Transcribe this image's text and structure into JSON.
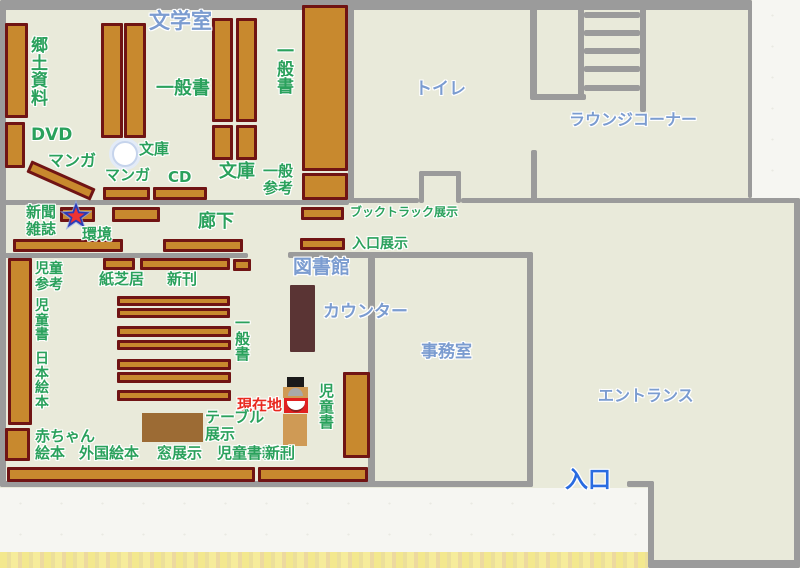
{
  "title": "図書館フロアマップ",
  "colors": {
    "background": "#e9eada",
    "wall": "#9b9b9b",
    "shelf_fill": "#c8892e",
    "shelf_border": "#701414",
    "green": "#2aa15c",
    "blue": "#7b9cd0",
    "blue_strong": "#2a6ce0",
    "red": "#e8281e",
    "counter": "#5a3434",
    "table": "#9c6b34",
    "kiosk_tan": "#cf9a55",
    "kiosk_red": "#e02020",
    "kiosk_black": "#1a1a1a",
    "star_red": "#ee3333",
    "star_blue": "#2b3ab5",
    "star_glow": "#8ea6e8",
    "paper": "#f6f6f2"
  },
  "canvas": {
    "width": 800,
    "height": 568
  },
  "paper_regions": [
    {
      "id": "paper-top-right",
      "x": 752,
      "y": 0,
      "w": 48,
      "h": 198
    },
    {
      "id": "paper-bottom-left",
      "x": 0,
      "y": 488,
      "w": 648,
      "h": 80
    }
  ],
  "yellow_band": {
    "id": "paper-edge-yellow",
    "x": 0,
    "y": 552,
    "w": 648,
    "h": 16
  },
  "walls": [
    {
      "id": "wall-top",
      "x": 0,
      "y": 0,
      "w": 752,
      "h": 10
    },
    {
      "id": "wall-left",
      "x": 0,
      "y": 0,
      "w": 6,
      "h": 487
    },
    {
      "id": "wall-bottom-left",
      "x": 0,
      "y": 481,
      "w": 533,
      "h": 6
    },
    {
      "id": "wall-corridor-top",
      "x": 0,
      "y": 200,
      "w": 349,
      "h": 5
    },
    {
      "id": "wall-corridor-bottom-left",
      "x": 0,
      "y": 253,
      "w": 248,
      "h": 5
    },
    {
      "id": "wall-corridor-bottom-right",
      "x": 288,
      "y": 252,
      "w": 245,
      "h": 6
    },
    {
      "id": "wall-toilet-left",
      "x": 348,
      "y": 5,
      "w": 6,
      "h": 198
    },
    {
      "id": "wall-toilet-bottom-a",
      "x": 348,
      "y": 198,
      "w": 71,
      "h": 5
    },
    {
      "id": "wall-toilet-door-notch-left",
      "x": 419,
      "y": 171,
      "w": 5,
      "h": 32
    },
    {
      "id": "wall-toilet-door-notch-top",
      "x": 419,
      "y": 171,
      "w": 42,
      "h": 5
    },
    {
      "id": "wall-toilet-door-notch-right",
      "x": 456,
      "y": 171,
      "w": 5,
      "h": 32
    },
    {
      "id": "wall-toilet-bottom-b",
      "x": 461,
      "y": 198,
      "w": 339,
      "h": 5
    },
    {
      "id": "wall-toilet-lounge-divider-top",
      "x": 530,
      "y": 0,
      "w": 7,
      "h": 98
    },
    {
      "id": "wall-lounge-balustrade",
      "x": 530,
      "y": 94,
      "w": 56,
      "h": 6
    },
    {
      "id": "wall-toilet-lounge-divider-bottom",
      "x": 531,
      "y": 150,
      "w": 6,
      "h": 53
    },
    {
      "id": "wall-map-right-top",
      "x": 748,
      "y": 0,
      "w": 4,
      "h": 198
    },
    {
      "id": "wall-office-left",
      "x": 368,
      "y": 257,
      "w": 7,
      "h": 226
    },
    {
      "id": "wall-office-right",
      "x": 527,
      "y": 252,
      "w": 6,
      "h": 235
    },
    {
      "id": "wall-entry-door-right",
      "x": 627,
      "y": 481,
      "w": 27,
      "h": 6
    },
    {
      "id": "wall-walkway-left",
      "x": 648,
      "y": 481,
      "w": 6,
      "h": 87
    },
    {
      "id": "wall-right",
      "x": 794,
      "y": 198,
      "w": 6,
      "h": 370
    },
    {
      "id": "wall-bottom-right",
      "x": 648,
      "y": 560,
      "w": 152,
      "h": 8
    }
  ],
  "stairs": {
    "rails": [
      {
        "id": "stairs-rail-left",
        "x": 578,
        "y": 8,
        "w": 6,
        "h": 92
      },
      {
        "id": "stairs-rail-right",
        "x": 640,
        "y": 8,
        "w": 6,
        "h": 104
      }
    ],
    "rungs": [
      {
        "id": "stairs-step",
        "x": 584,
        "y": 12,
        "w": 56,
        "h": 6
      },
      {
        "id": "stairs-step",
        "x": 584,
        "y": 30,
        "w": 56,
        "h": 6
      },
      {
        "id": "stairs-step",
        "x": 584,
        "y": 48,
        "w": 56,
        "h": 6
      },
      {
        "id": "stairs-step",
        "x": 584,
        "y": 66,
        "w": 56,
        "h": 6
      },
      {
        "id": "stairs-step",
        "x": 584,
        "y": 85,
        "w": 56,
        "h": 6
      }
    ]
  },
  "shelves": [
    {
      "id": "shelf-kyodo-shiryo",
      "x": 5,
      "y": 23,
      "w": 23,
      "h": 95
    },
    {
      "id": "shelf-dvd",
      "x": 5,
      "y": 122,
      "w": 20,
      "h": 46
    },
    {
      "id": "shelf-manga-diagonal",
      "x": 26,
      "y": 174,
      "w": 70,
      "h": 13,
      "rot": 24
    },
    {
      "id": "shelf-ippansho-a",
      "x": 101,
      "y": 23,
      "w": 22,
      "h": 115
    },
    {
      "id": "shelf-ippansho-b",
      "x": 124,
      "y": 23,
      "w": 22,
      "h": 115
    },
    {
      "id": "shelf-manga",
      "x": 103,
      "y": 187,
      "w": 47,
      "h": 13
    },
    {
      "id": "shelf-cd",
      "x": 153,
      "y": 187,
      "w": 54,
      "h": 13
    },
    {
      "id": "shelf-bunko-a",
      "x": 212,
      "y": 18,
      "w": 21,
      "h": 104
    },
    {
      "id": "shelf-bunko-b",
      "x": 236,
      "y": 18,
      "w": 21,
      "h": 104
    },
    {
      "id": "shelf-bunko-c",
      "x": 212,
      "y": 125,
      "w": 21,
      "h": 35
    },
    {
      "id": "shelf-bunko-d",
      "x": 236,
      "y": 125,
      "w": 21,
      "h": 35
    },
    {
      "id": "shelf-ippansho-tall",
      "x": 302,
      "y": 5,
      "w": 46,
      "h": 166
    },
    {
      "id": "shelf-ippan-sanko",
      "x": 302,
      "y": 173,
      "w": 46,
      "h": 27
    },
    {
      "id": "shelf-shinbun-zasshi",
      "x": 60,
      "y": 207,
      "w": 35,
      "h": 15
    },
    {
      "id": "shelf-kankyo",
      "x": 112,
      "y": 207,
      "w": 48,
      "h": 15
    },
    {
      "id": "shelf-booktruck-tenji",
      "x": 301,
      "y": 207,
      "w": 43,
      "h": 13
    },
    {
      "id": "shelf-corridor-a",
      "x": 13,
      "y": 239,
      "w": 110,
      "h": 13
    },
    {
      "id": "shelf-corridor-b",
      "x": 163,
      "y": 239,
      "w": 80,
      "h": 13
    },
    {
      "id": "shelf-iriguchi-tenji",
      "x": 300,
      "y": 238,
      "w": 45,
      "h": 12
    },
    {
      "id": "shelf-kamishibai",
      "x": 103,
      "y": 258,
      "w": 32,
      "h": 12
    },
    {
      "id": "shelf-shinkan",
      "x": 140,
      "y": 258,
      "w": 90,
      "h": 12
    },
    {
      "id": "shelf-shinkan-end",
      "x": 233,
      "y": 259,
      "w": 18,
      "h": 12
    },
    {
      "id": "shelf-jido-left-tall",
      "x": 8,
      "y": 258,
      "w": 24,
      "h": 167
    },
    {
      "id": "shelf-row-1",
      "x": 117,
      "y": 296,
      "w": 113,
      "h": 10
    },
    {
      "id": "shelf-row-2",
      "x": 117,
      "y": 308,
      "w": 113,
      "h": 10
    },
    {
      "id": "shelf-row-3",
      "x": 117,
      "y": 326,
      "w": 114,
      "h": 11
    },
    {
      "id": "shelf-row-4",
      "x": 117,
      "y": 340,
      "w": 114,
      "h": 10
    },
    {
      "id": "shelf-row-5",
      "x": 117,
      "y": 359,
      "w": 114,
      "h": 11
    },
    {
      "id": "shelf-row-6",
      "x": 117,
      "y": 372,
      "w": 114,
      "h": 11
    },
    {
      "id": "shelf-row-7",
      "x": 117,
      "y": 390,
      "w": 114,
      "h": 11
    },
    {
      "id": "shelf-akachan-ehon",
      "x": 5,
      "y": 428,
      "w": 25,
      "h": 33
    },
    {
      "id": "shelf-jidosho-right",
      "x": 343,
      "y": 372,
      "w": 27,
      "h": 86
    },
    {
      "id": "shelf-window-left",
      "x": 7,
      "y": 467,
      "w": 248,
      "h": 15
    },
    {
      "id": "shelf-window-right",
      "x": 258,
      "y": 467,
      "w": 110,
      "h": 15
    }
  ],
  "labels": [
    {
      "id": "label-bungakushitsu",
      "text": "文学室",
      "x": 149,
      "y": 10,
      "size": 21,
      "color": "blue"
    },
    {
      "id": "label-kyodo-shiryo",
      "text": "郷土資料",
      "x": 31,
      "y": 38,
      "size": 17,
      "color": "green",
      "vertical": true
    },
    {
      "id": "label-dvd",
      "text": "DVD",
      "x": 31,
      "y": 126,
      "size": 17,
      "color": "green"
    },
    {
      "id": "label-manga-diagonal",
      "text": "マンガ",
      "x": 48,
      "y": 152,
      "size": 16,
      "color": "green"
    },
    {
      "id": "label-ippansho-top",
      "text": "一般書",
      "x": 156,
      "y": 79,
      "size": 18,
      "color": "green"
    },
    {
      "id": "label-bunko-pillar",
      "text": "文庫",
      "x": 139,
      "y": 141,
      "size": 15,
      "color": "green"
    },
    {
      "id": "label-manga",
      "text": "マンガ",
      "x": 105,
      "y": 167,
      "size": 15,
      "color": "green"
    },
    {
      "id": "label-cd",
      "text": "CD",
      "x": 168,
      "y": 169,
      "size": 15,
      "color": "green"
    },
    {
      "id": "label-bunko-right",
      "text": "文庫",
      "x": 219,
      "y": 162,
      "size": 18,
      "color": "green"
    },
    {
      "id": "label-ippansho-right",
      "text": "一般書",
      "x": 277,
      "y": 44,
      "size": 17,
      "color": "green",
      "vertical": true
    },
    {
      "id": "label-ippan-sanko",
      "text": "一般\n参考",
      "x": 263,
      "y": 163,
      "size": 15,
      "color": "green"
    },
    {
      "id": "label-toire",
      "text": "トイレ",
      "x": 415,
      "y": 80,
      "size": 17,
      "color": "blue"
    },
    {
      "id": "label-lounge-corner",
      "text": "ラウンジコーナー",
      "x": 569,
      "y": 111,
      "size": 16,
      "color": "blue"
    },
    {
      "id": "label-booktruck-tenji",
      "text": "ブックトラック展示",
      "x": 350,
      "y": 206,
      "size": 12,
      "color": "green"
    },
    {
      "id": "label-iriguchi-tenji",
      "text": "入口展示",
      "x": 352,
      "y": 237,
      "size": 14,
      "color": "green"
    },
    {
      "id": "label-shinbun-zasshi",
      "text": "新聞\n雑誌",
      "x": 26,
      "y": 204,
      "size": 15,
      "color": "green"
    },
    {
      "id": "label-kankyo",
      "text": "環境",
      "x": 82,
      "y": 226,
      "size": 15,
      "color": "green"
    },
    {
      "id": "label-rouka",
      "text": "廊下",
      "x": 198,
      "y": 212,
      "size": 18,
      "color": "green"
    },
    {
      "id": "label-toshokan",
      "text": "図書館",
      "x": 293,
      "y": 257,
      "size": 19,
      "color": "blue"
    },
    {
      "id": "label-counter",
      "text": "カウンター",
      "x": 323,
      "y": 303,
      "size": 17,
      "color": "blue"
    },
    {
      "id": "label-jido-sanko",
      "text": "児童\n参考",
      "x": 35,
      "y": 262,
      "size": 14,
      "color": "green"
    },
    {
      "id": "label-kamishibai",
      "text": "紙芝居",
      "x": 99,
      "y": 271,
      "size": 15,
      "color": "green"
    },
    {
      "id": "label-shinkan-corridor",
      "text": "新刊",
      "x": 167,
      "y": 271,
      "size": 15,
      "color": "green"
    },
    {
      "id": "label-jidosho-left",
      "text": "児童書",
      "x": 35,
      "y": 299,
      "size": 14,
      "color": "green",
      "vertical": true
    },
    {
      "id": "label-ippansho-children",
      "text": "一般書",
      "x": 235,
      "y": 316,
      "size": 15,
      "color": "green",
      "vertical": true
    },
    {
      "id": "label-nihon-ehon",
      "text": "日本絵本",
      "x": 35,
      "y": 352,
      "size": 14,
      "color": "green",
      "vertical": true
    },
    {
      "id": "label-jimushitsu",
      "text": "事務室",
      "x": 421,
      "y": 343,
      "size": 17,
      "color": "blue"
    },
    {
      "id": "label-entrance-hall",
      "text": "エントランス",
      "x": 598,
      "y": 387,
      "size": 16,
      "color": "blue"
    },
    {
      "id": "label-genzaichi",
      "text": "現在地",
      "x": 237,
      "y": 397,
      "size": 15,
      "color": "red"
    },
    {
      "id": "label-jidosho-kiosk",
      "text": "児童書",
      "x": 319,
      "y": 384,
      "size": 15,
      "color": "green",
      "vertical": true
    },
    {
      "id": "label-table-tenji",
      "text": "テーブル\n展示",
      "x": 205,
      "y": 409,
      "size": 15,
      "color": "green"
    },
    {
      "id": "label-akachan-ehon",
      "text": "赤ちゃん\n絵本",
      "x": 35,
      "y": 428,
      "size": 15,
      "color": "green"
    },
    {
      "id": "label-gaikoku-ehon",
      "text": "外国絵本",
      "x": 79,
      "y": 445,
      "size": 15,
      "color": "green"
    },
    {
      "id": "label-mado-tenji",
      "text": "窓展示",
      "x": 157,
      "y": 445,
      "size": 15,
      "color": "green"
    },
    {
      "id": "label-jidosho-shinkan",
      "text": "児童書新刊",
      "x": 217,
      "y": 445,
      "size": 15,
      "color": "green"
    },
    {
      "id": "label-shinkan-bottom",
      "text": "新刊",
      "x": 265,
      "y": 445,
      "size": 15,
      "color": "green"
    },
    {
      "id": "label-iriguchi",
      "text": "入口",
      "x": 565,
      "y": 467,
      "size": 23,
      "color": "blue_strong"
    }
  ],
  "objects": {
    "counter": {
      "id": "counter-desk",
      "x": 290,
      "y": 285,
      "w": 25,
      "h": 67
    },
    "display_table": {
      "id": "display-table",
      "x": 142,
      "y": 413,
      "w": 61,
      "h": 29
    },
    "pillar": {
      "id": "pillar",
      "x": 112,
      "y": 141,
      "w": 22,
      "h": 22
    },
    "star_marker": {
      "id": "current-location-star",
      "cx": 76,
      "cy": 216
    },
    "kiosk": {
      "head": {
        "id": "kiosk-head",
        "x": 287,
        "y": 377,
        "w": 17,
        "h": 10
      },
      "base": {
        "id": "kiosk-base",
        "x": 283,
        "y": 387,
        "w": 25,
        "h": 11
      },
      "dome": {
        "id": "kiosk-dome",
        "x": 288,
        "y": 388,
        "w": 15,
        "h": 8
      },
      "red_box": {
        "id": "kiosk-red-box",
        "x": 284,
        "y": 398,
        "w": 24,
        "h": 15
      },
      "bowl": {
        "id": "kiosk-bowl",
        "x": 287,
        "y": 401,
        "w": 18,
        "h": 9
      },
      "column": {
        "id": "kiosk-column",
        "x": 283,
        "y": 414,
        "w": 24,
        "h": 32
      }
    }
  }
}
